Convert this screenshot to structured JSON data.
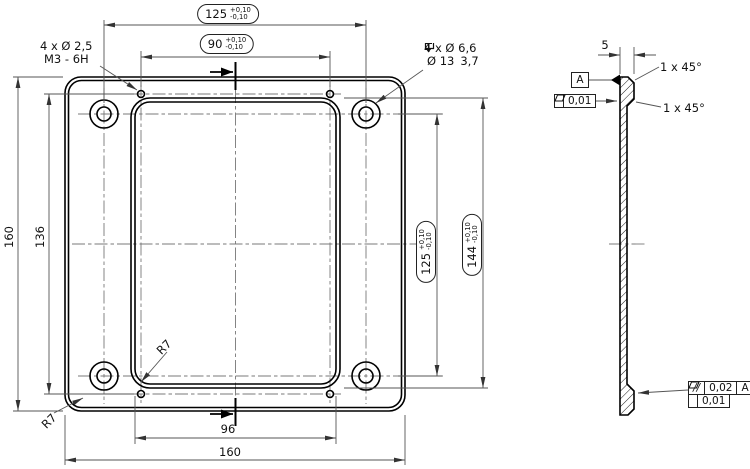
{
  "front_view": {
    "dim_hole_pattern_width": {
      "value": "125",
      "tol_plus": "+0,10",
      "tol_minus": "-0,10"
    },
    "dim_tapped_pattern_width": {
      "value": "90",
      "tol_plus": "+0,10",
      "tol_minus": "-0,10"
    },
    "dim_plate_height": "160",
    "dim_tapped_pattern_height": "136",
    "dim_hole_pattern_height": {
      "value": "125",
      "tol_plus": "+0,10",
      "tol_minus": "-0,10"
    },
    "dim_pocket_height": {
      "value": "144",
      "tol_plus": "+0,10",
      "tol_minus": "-0,10"
    },
    "dim_pocket_width": "96",
    "dim_plate_width": "160",
    "callout_tapped_holes": {
      "line1": "4 x Ø 2,5",
      "line2": "M3 - 6H"
    },
    "callout_counterbore": {
      "line1": "4 x Ø 6,6",
      "bore_dia": "Ø 13",
      "bore_depth": "3,7"
    },
    "radius_pocket": "R7",
    "radius_plate": "R7"
  },
  "side_view": {
    "dim_thickness": "5",
    "chamfer_top": "1 x 45°",
    "chamfer_bottom": "1 x 45°",
    "datum_label": "A",
    "flatness": {
      "value": "0,01"
    },
    "parallelism": {
      "symbol": "//",
      "value": "0,02",
      "datum": "A"
    },
    "flatness_bottom": {
      "value": "0,01"
    }
  },
  "colors": {
    "object_line": "#000000",
    "thin_line": "#555555",
    "centerline": "#787878",
    "background": "#ffffff"
  }
}
